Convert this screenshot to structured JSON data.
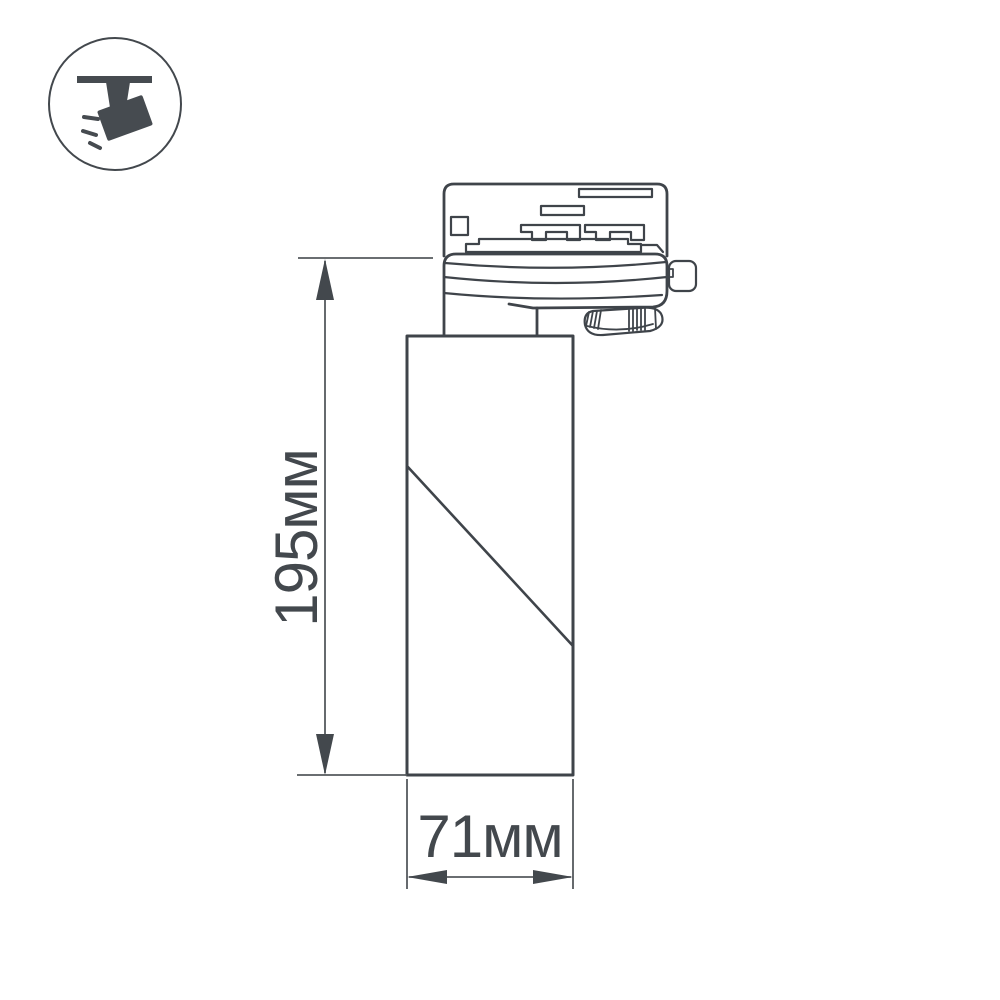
{
  "colors": {
    "outline": "#3f444a",
    "dimension_line": "#55595d",
    "label_text": "#43484d",
    "icon_fill": "#464b50",
    "background": "#ffffff"
  },
  "badge": {
    "icon_name": "track-spotlight-icon"
  },
  "dimensions": {
    "height": {
      "label": "195мм"
    },
    "width": {
      "label": "71мм"
    }
  }
}
